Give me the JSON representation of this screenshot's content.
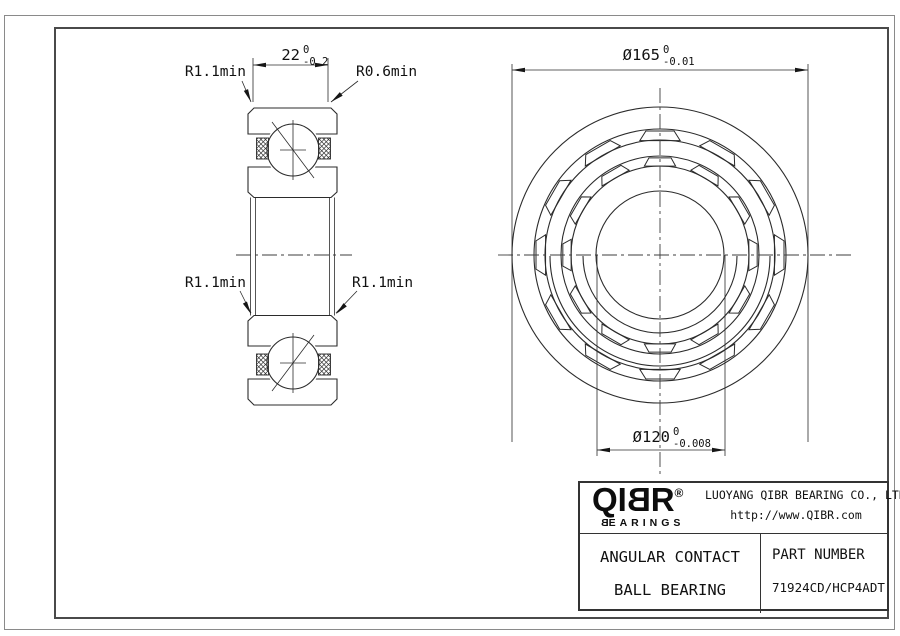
{
  "drawing": {
    "side_view": {
      "labels": {
        "top_left": "R1.1min",
        "top_right": "R0.6min",
        "mid_left": "R1.1min",
        "mid_right": "R1.1min"
      },
      "width_dim": {
        "value": "22",
        "tol_upper": "0",
        "tol_lower": "-0.2"
      }
    },
    "front_view": {
      "outer_dia_dim": {
        "value": "Ø165",
        "tol_upper": "0",
        "tol_lower": "-0.01"
      },
      "bore_dia_dim": {
        "value": "Ø120",
        "tol_upper": "0",
        "tol_lower": "-0.008"
      }
    }
  },
  "title_block": {
    "logo": {
      "l1": "Q",
      "l2": "I",
      "l3": "B",
      "l4": "R",
      "registered": "®",
      "subtext_first": "B",
      "subtext_rest": "EARINGS"
    },
    "company": "LUOYANG QIBR BEARING CO., LTD",
    "website": "http://www.QIBR.com",
    "product_line1": "ANGULAR CONTACT",
    "product_line2": "BALL BEARING",
    "part_label": "PART NUMBER",
    "part_number": "71924CD/HCP4ADT"
  }
}
